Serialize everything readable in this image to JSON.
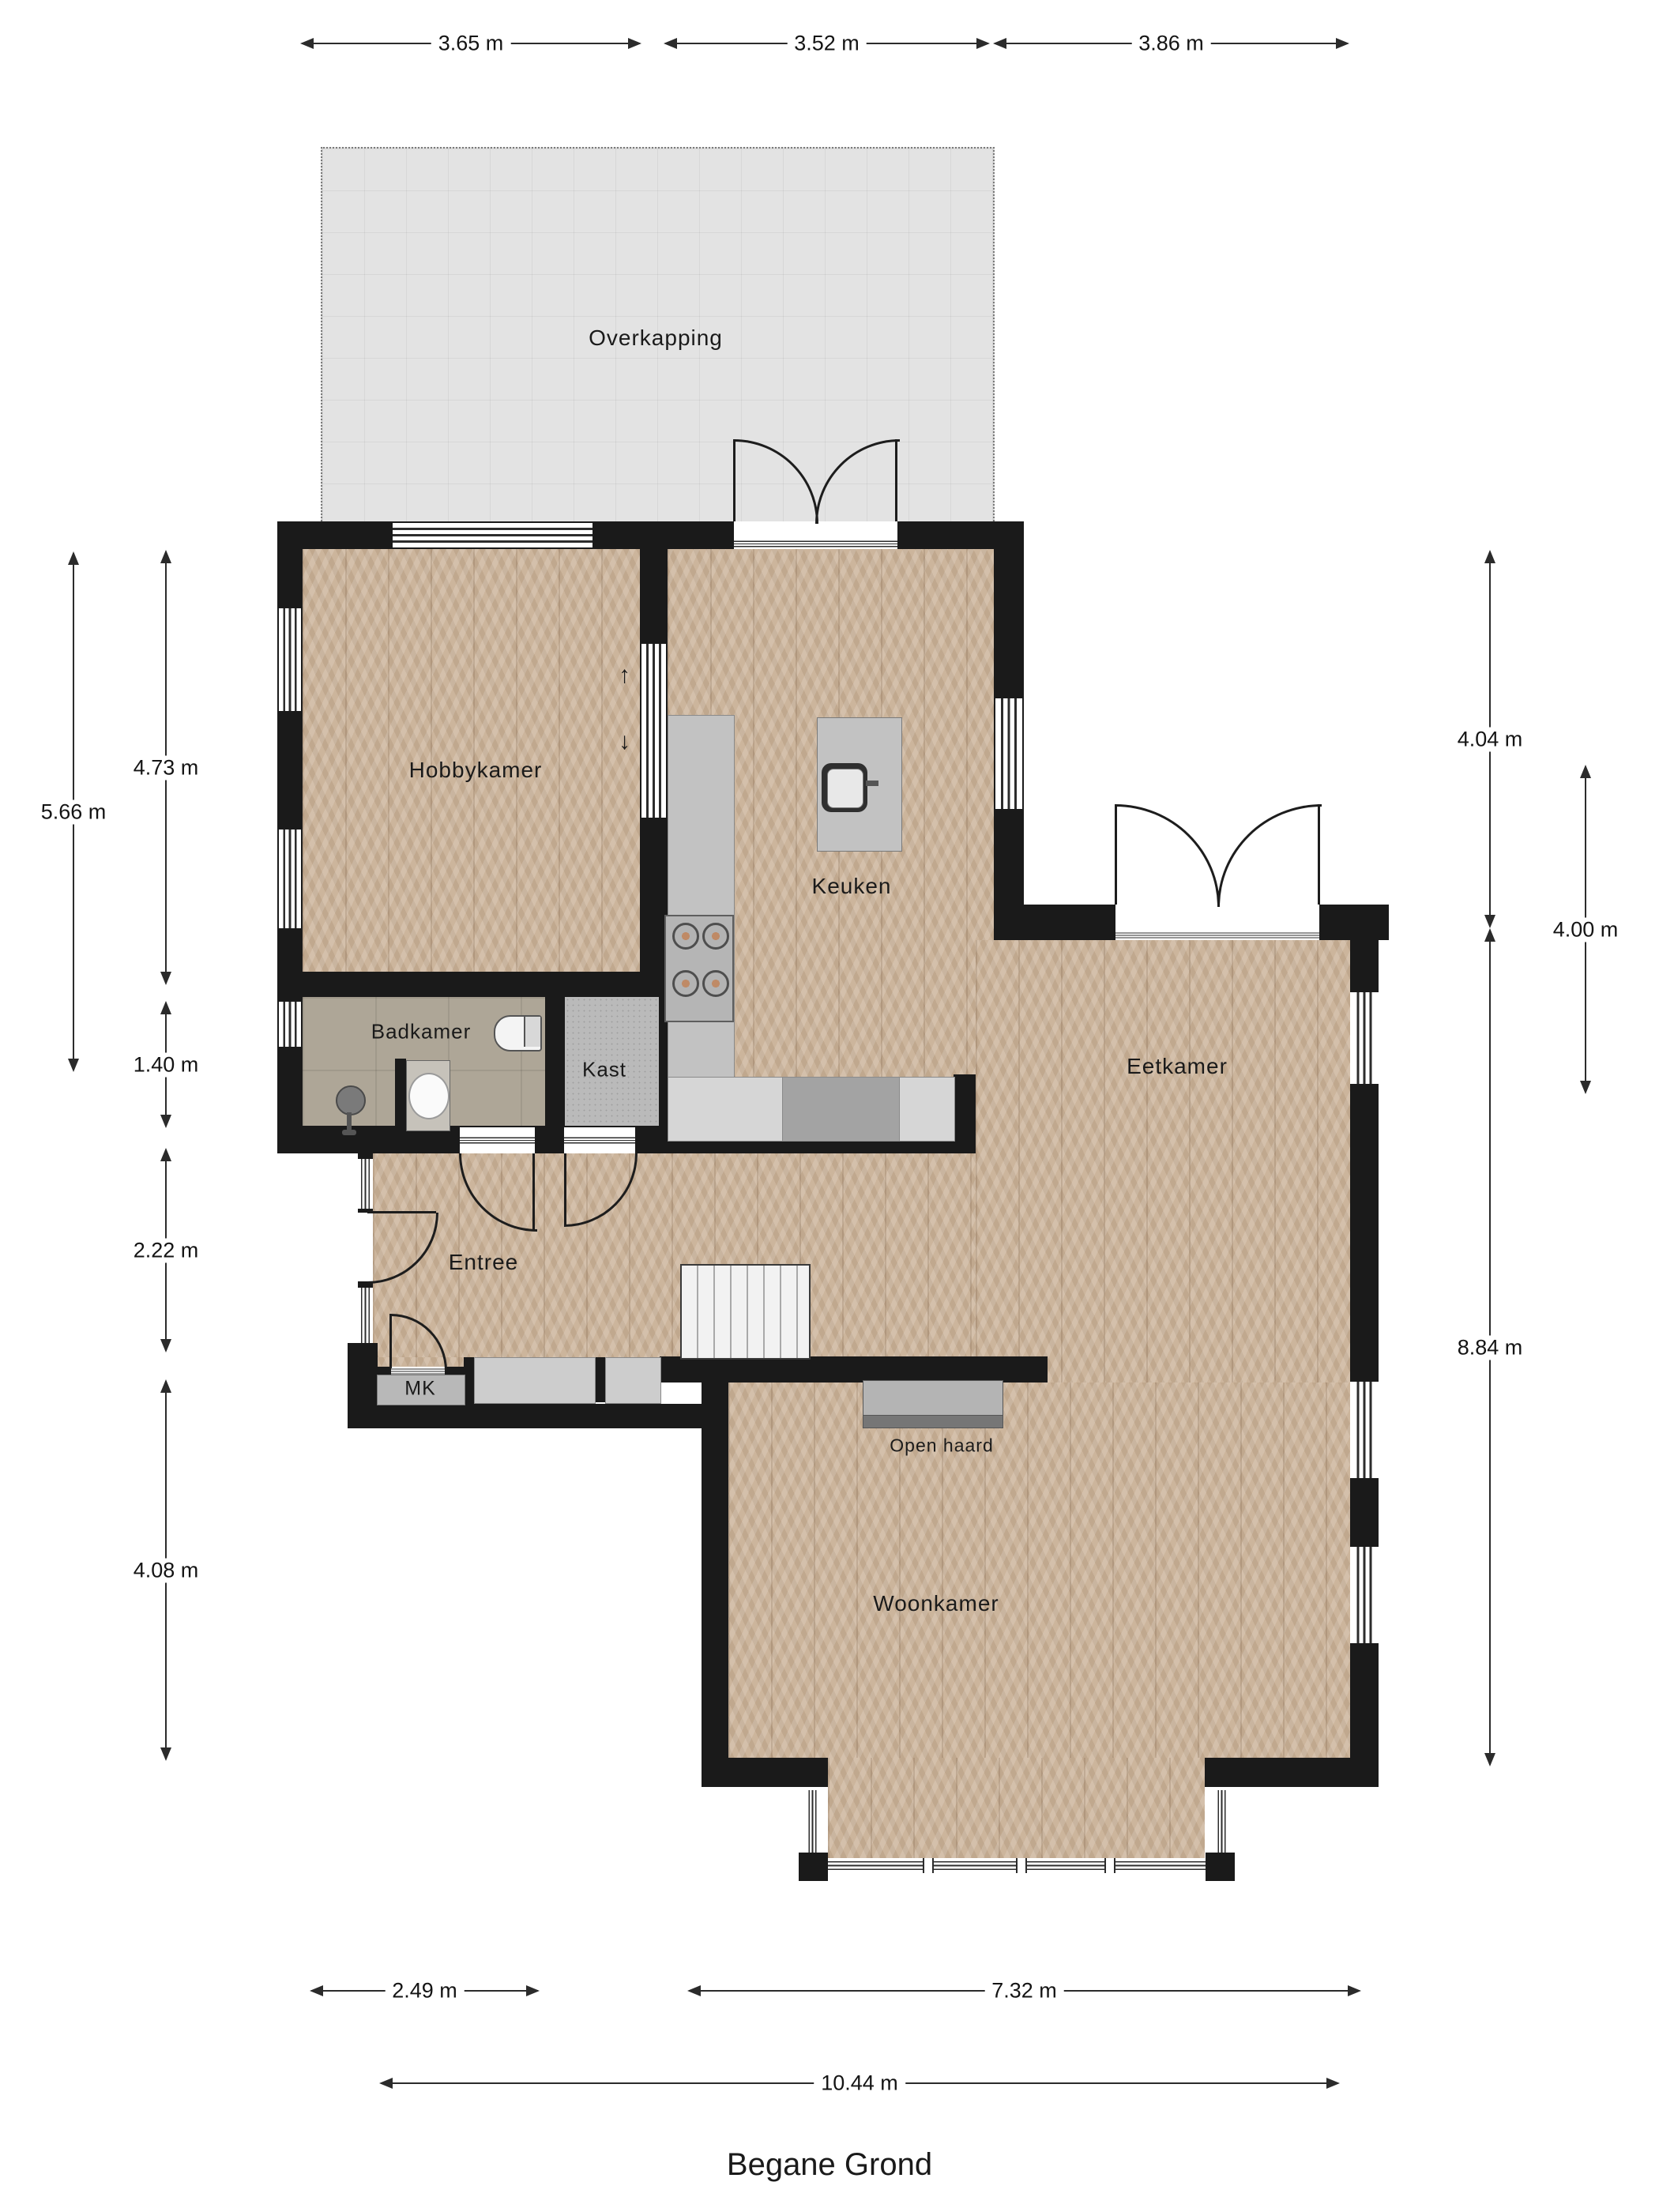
{
  "title": "Begane Grond",
  "rooms": {
    "overkapping": "Overkapping",
    "hobbykamer": "Hobbykamer",
    "keuken": "Keuken",
    "badkamer": "Badkamer",
    "kast": "Kast",
    "entree": "Entree",
    "mk": "MK",
    "eetkamer": "Eetkamer",
    "woonkamer": "Woonkamer",
    "open_haard": "Open haard"
  },
  "dims": {
    "top": [
      {
        "label": "3.65 m"
      },
      {
        "label": "3.52 m"
      },
      {
        "label": "3.86 m"
      }
    ],
    "bottom": [
      {
        "label": "2.49 m"
      },
      {
        "label": "7.32 m"
      },
      {
        "label": "10.44 m"
      }
    ],
    "left": [
      {
        "label": "5.66 m"
      },
      {
        "label": "4.73 m"
      },
      {
        "label": "1.40 m"
      },
      {
        "label": "2.22 m"
      },
      {
        "label": "4.08 m"
      }
    ],
    "right": [
      {
        "label": "4.04 m"
      },
      {
        "label": "8.84 m"
      },
      {
        "label": "4.00 m"
      }
    ]
  },
  "passage_arrows": {
    "up": "↑",
    "down": "↓"
  },
  "colors": {
    "wall": "#1a1a1a",
    "wood": "#ccb59c",
    "overkapping": "#e3e3e3",
    "bath_tile": "#aea697",
    "counter": "#c2c2c2"
  }
}
